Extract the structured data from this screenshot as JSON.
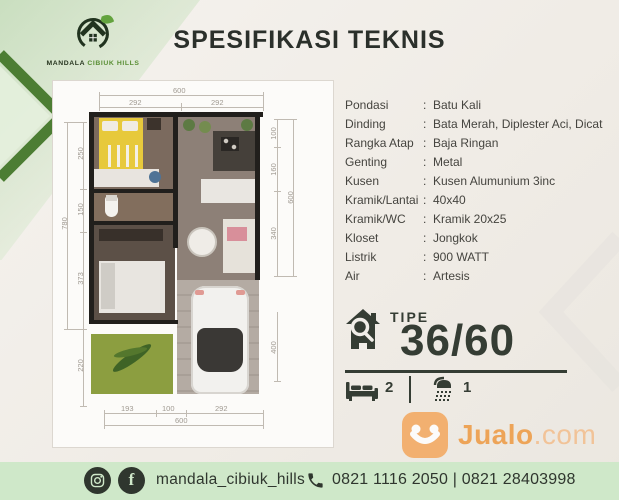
{
  "brand": {
    "word1": "MANDALA",
    "word2": "CIBIUK HILLS"
  },
  "header": {
    "title": "SPESIFIKASI TEKNIS"
  },
  "specs": {
    "colon": ":",
    "rows": [
      {
        "label": "Pondasi",
        "value": "Batu Kali"
      },
      {
        "label": "Dinding",
        "value": "Bata Merah, Diplester Aci, Dicat"
      },
      {
        "label": "Rangka Atap",
        "value": "Baja Ringan"
      },
      {
        "label": "Genting",
        "value": "Metal"
      },
      {
        "label": "Kusen",
        "value": "Kusen Alumunium 3inc"
      },
      {
        "label": "Kramik/Lantai",
        "value": "40x40"
      },
      {
        "label": "Kramik/WC",
        "value": "Kramik 20x25"
      },
      {
        "label": "Kloset",
        "value": "Jongkok"
      },
      {
        "label": "Listrik",
        "value": "900 WATT"
      },
      {
        "label": "Air",
        "value": "Artesis"
      }
    ]
  },
  "tipe": {
    "label": "TIPE",
    "value": "36/60",
    "bedrooms": "2",
    "bathrooms": "1"
  },
  "floorplan": {
    "dims": {
      "top_total": "600",
      "top_left": "292",
      "top_right": "292",
      "left_total": "780",
      "left_1": "250",
      "left_2": "150",
      "left_3": "373",
      "left_4": "220",
      "right_1": "100",
      "right_2": "160",
      "right_3": "340",
      "right_total": "600",
      "right_4": "400",
      "bottom_1": "193",
      "bottom_2": "100",
      "bottom_3": "292",
      "bottom_total": "600"
    }
  },
  "watermark": {
    "brand_bold": "Jualo",
    "brand_suffix": ".com"
  },
  "footer": {
    "social_handle": "mandala_cibiuk_hills",
    "phones": "0821 1116 2050 | 0821 28403998",
    "facebook_glyph": "f"
  },
  "colors": {
    "accent_green": "#4c7d33",
    "footer_green": "#cfe8c9",
    "jualo_orange": "#f3a75c",
    "dark_green": "#2f362e"
  }
}
